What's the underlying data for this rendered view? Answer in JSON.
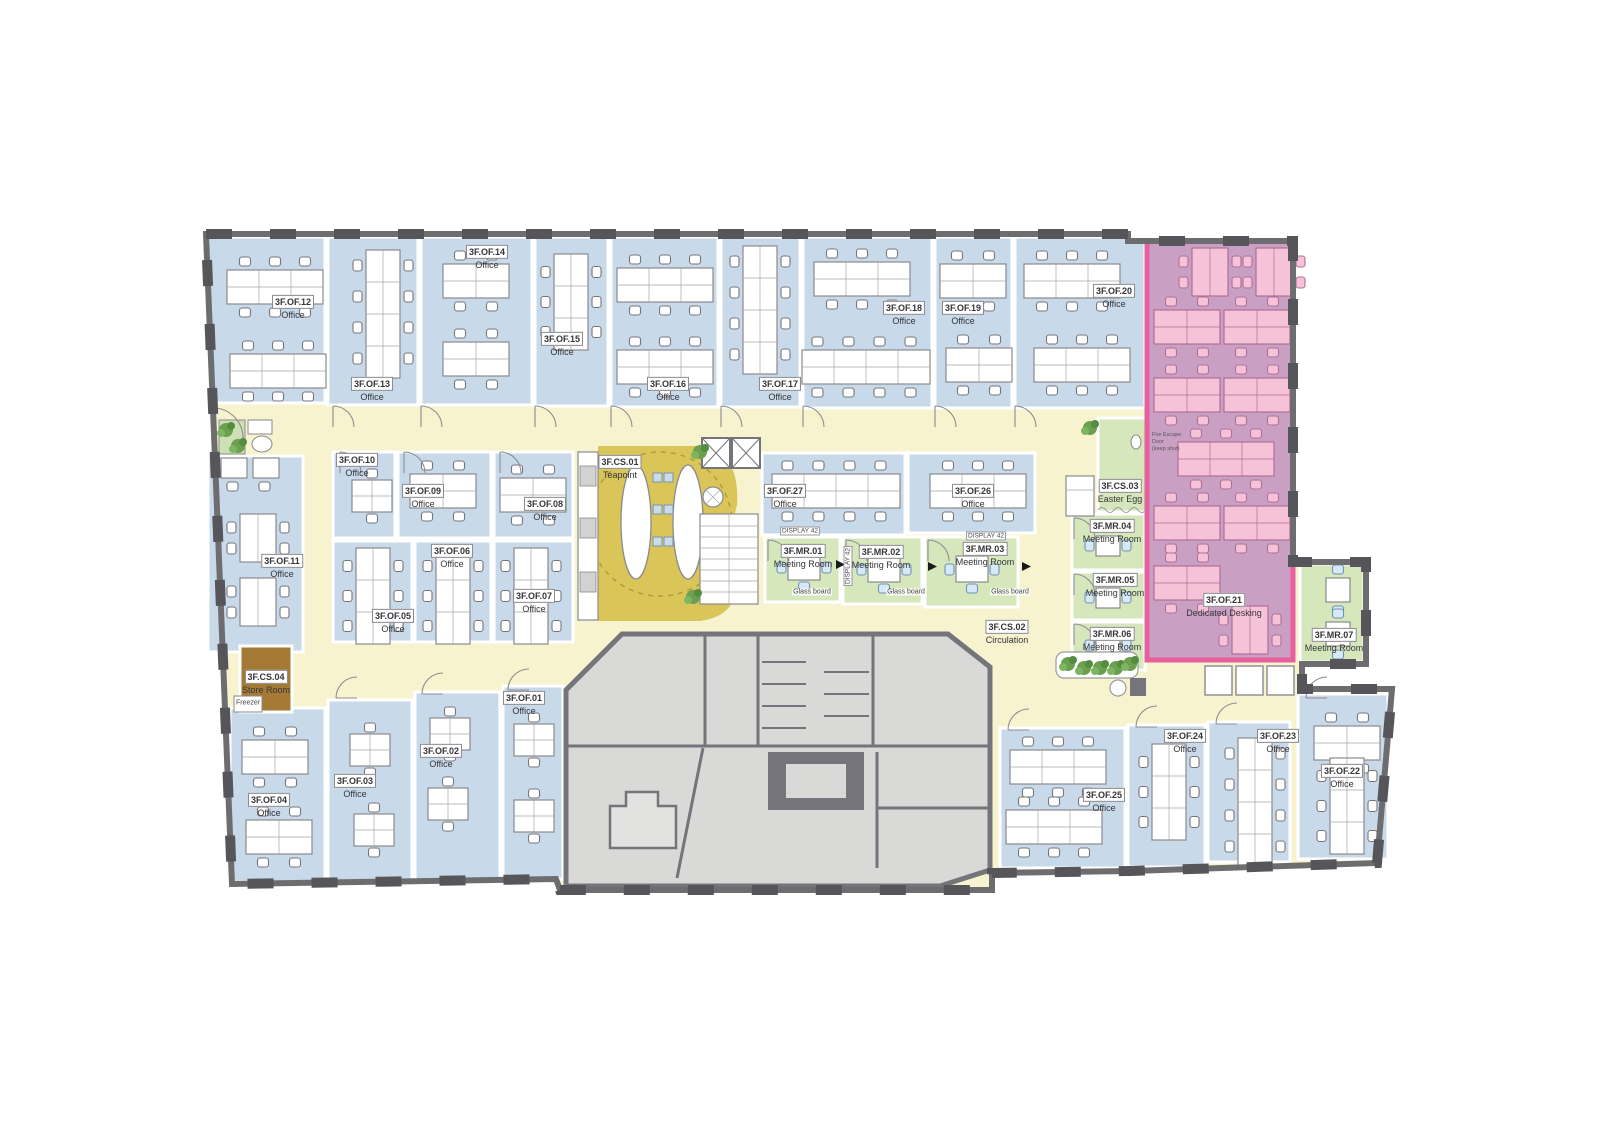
{
  "floor": {
    "rooms": {
      "of01": {
        "id": "3F.OF.01",
        "type": "Office"
      },
      "of02": {
        "id": "3F.OF.02",
        "type": "Office"
      },
      "of03": {
        "id": "3F.OF.03",
        "type": "Office"
      },
      "of04": {
        "id": "3F.OF.04",
        "type": "Office"
      },
      "of05": {
        "id": "3F.OF.05",
        "type": "Office"
      },
      "of06": {
        "id": "3F.OF.06",
        "type": "Office"
      },
      "of07": {
        "id": "3F.OF.07",
        "type": "Office"
      },
      "of08": {
        "id": "3F.OF.08",
        "type": "Office"
      },
      "of09": {
        "id": "3F.OF.09",
        "type": "Office"
      },
      "of10": {
        "id": "3F.OF.10",
        "type": "Office"
      },
      "of11": {
        "id": "3F.OF.11",
        "type": "Office"
      },
      "of12": {
        "id": "3F.OF.12",
        "type": "Office"
      },
      "of13": {
        "id": "3F.OF.13",
        "type": "Office"
      },
      "of14": {
        "id": "3F.OF.14",
        "type": "Office"
      },
      "of15": {
        "id": "3F.OF.15",
        "type": "Office"
      },
      "of16": {
        "id": "3F.OF.16",
        "type": "Office"
      },
      "of17": {
        "id": "3F.OF.17",
        "type": "Office"
      },
      "of18": {
        "id": "3F.OF.18",
        "type": "Office"
      },
      "of19": {
        "id": "3F.OF.19",
        "type": "Office"
      },
      "of20": {
        "id": "3F.OF.20",
        "type": "Office"
      },
      "of21": {
        "id": "3F.OF.21",
        "type": "Dedicated Desking"
      },
      "of22": {
        "id": "3F.OF.22",
        "type": "Office"
      },
      "of23": {
        "id": "3F.OF.23",
        "type": "Office"
      },
      "of24": {
        "id": "3F.OF.24",
        "type": "Office"
      },
      "of25": {
        "id": "3F.OF.25",
        "type": "Office"
      },
      "of26": {
        "id": "3F.OF.26",
        "type": "Office"
      },
      "of27": {
        "id": "3F.OF.27",
        "type": "Office"
      },
      "cs01": {
        "id": "3F.CS.01",
        "type": "Teapoint"
      },
      "cs02": {
        "id": "3F.CS.02",
        "type": "Circulation"
      },
      "cs03": {
        "id": "3F.CS.03",
        "type": "Easter Egg"
      },
      "cs04": {
        "id": "3F.CS.04",
        "type": "Store Room"
      },
      "mr01": {
        "id": "3F.MR.01",
        "type": "Meeting Room"
      },
      "mr02": {
        "id": "3F.MR.02",
        "type": "Meeting Room"
      },
      "mr03": {
        "id": "3F.MR.03",
        "type": "Meeting Room"
      },
      "mr04": {
        "id": "3F.MR.04",
        "type": "Meeting Room"
      },
      "mr05": {
        "id": "3F.MR.05",
        "type": "Meeting Room"
      },
      "mr06": {
        "id": "3F.MR.06",
        "type": "Meeting Room"
      },
      "mr07": {
        "id": "3F.MR.07",
        "type": "Meeting Room"
      }
    },
    "annotations": {
      "glass_board": "Glass board",
      "display": "DISPLAY 42",
      "freezer": "Freezer",
      "fire1": "Fire Escape",
      "fire2": "Door",
      "fire3": "(keep shut)"
    },
    "colors": {
      "office_fill": "#c8d9ea",
      "corridor_fill": "#f7f3cf",
      "teapoint_fill": "#d9c558",
      "meeting_fill": "#d5e7bb",
      "dedicated_fill": "#c9a0c4",
      "dedicated_border": "#e85f9e",
      "dedicated_desk": "#f5c2d7",
      "store_fill": "#a57a35",
      "core_fill": "#d9d9d7",
      "wall": "#6d6d70"
    }
  }
}
